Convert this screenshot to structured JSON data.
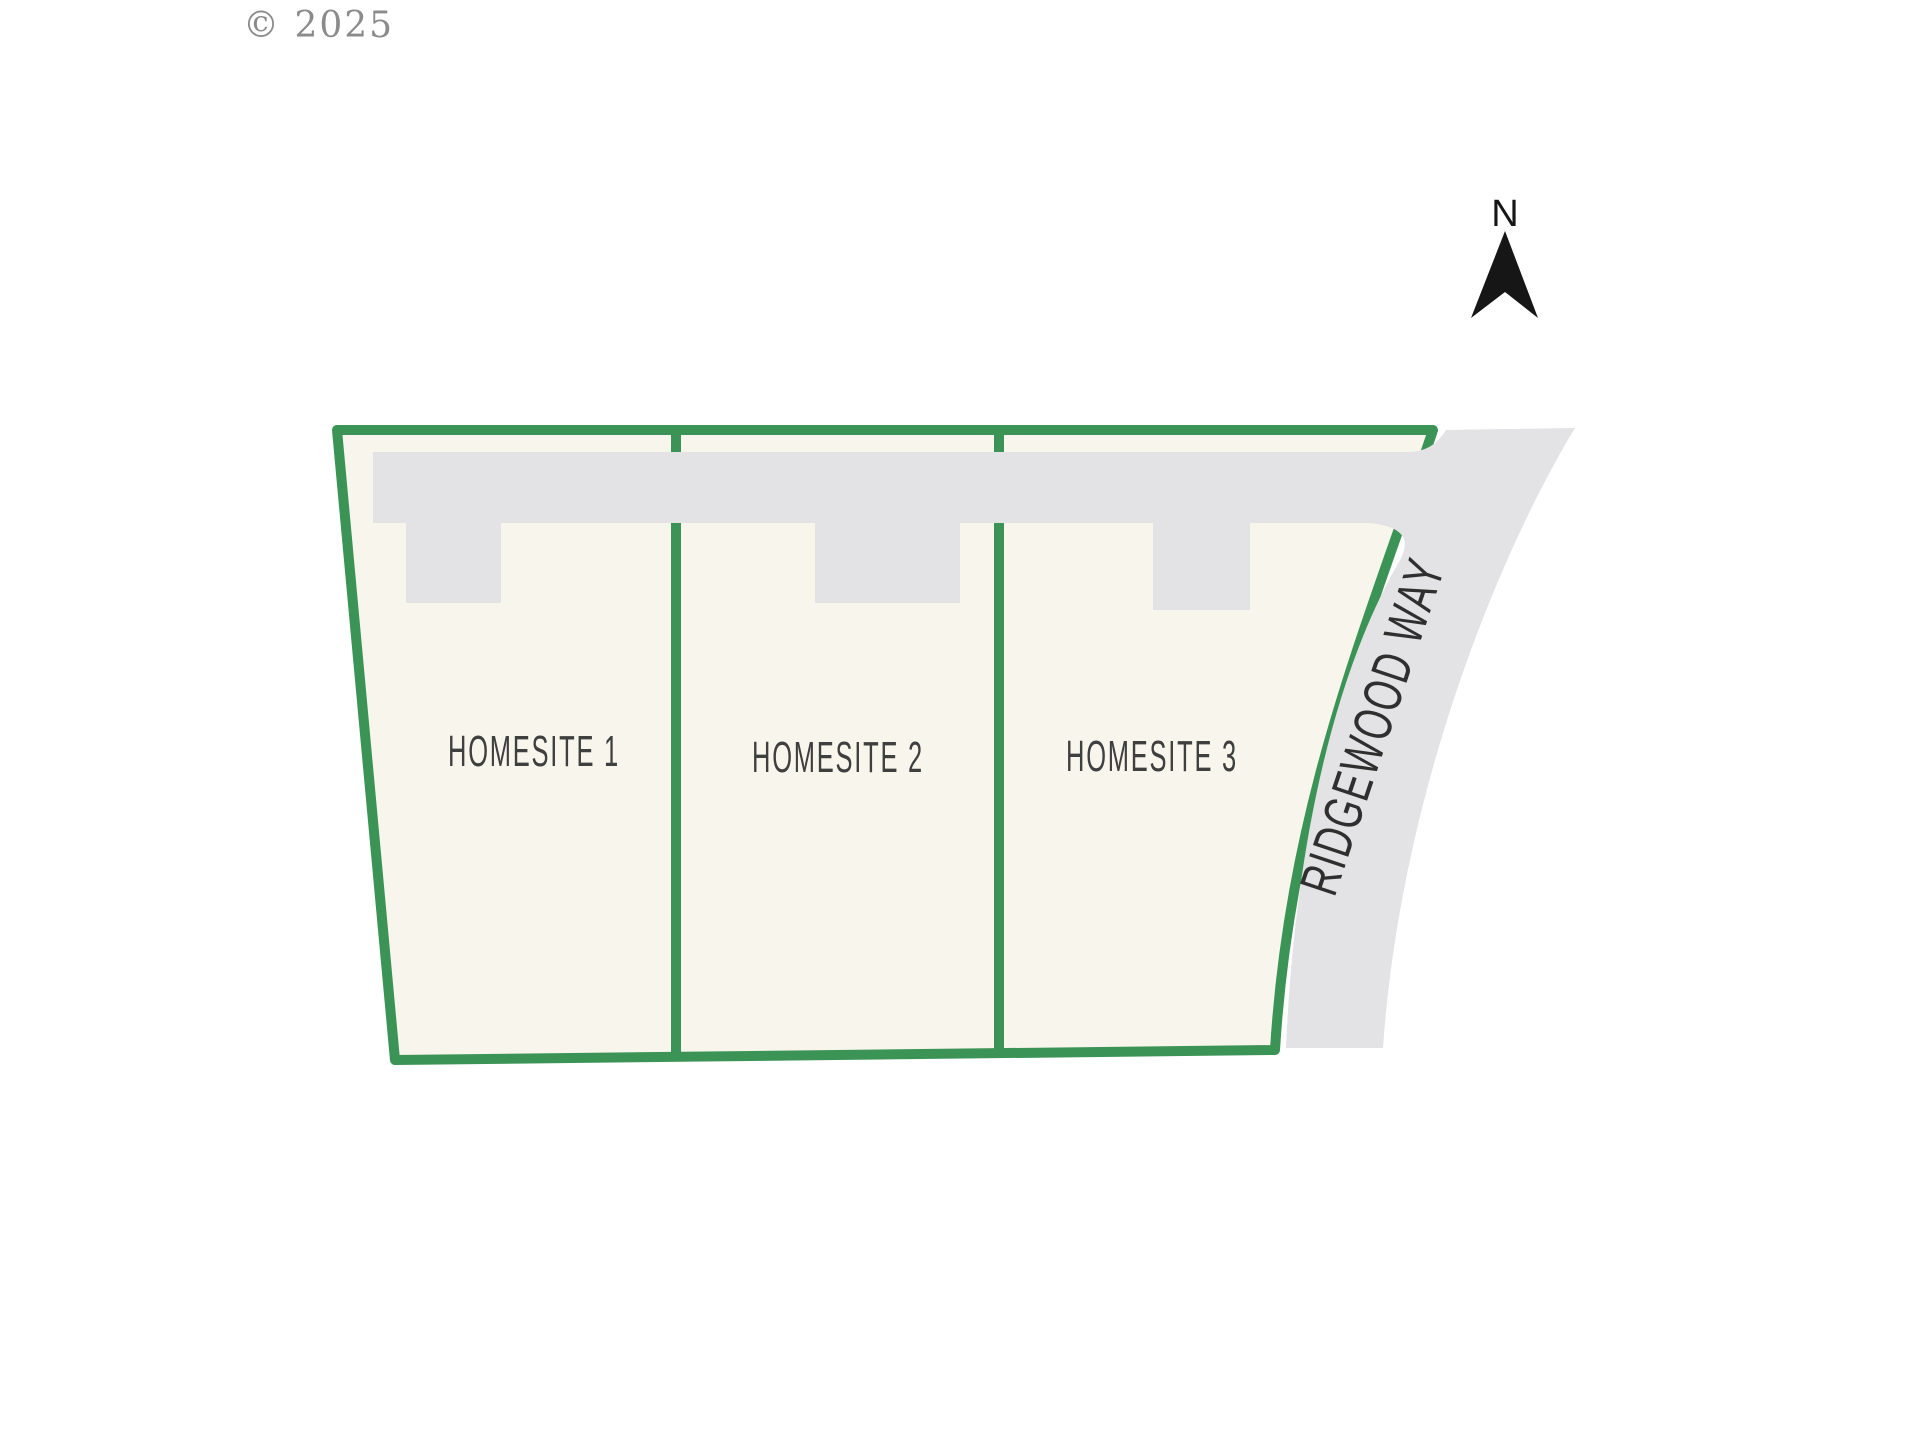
{
  "meta": {
    "copyright": "© 2025"
  },
  "north_indicator": {
    "label": "N"
  },
  "site_plan": {
    "lots": [
      {
        "label": "HOMESITE 1"
      },
      {
        "label": "HOMESITE 2"
      },
      {
        "label": "HOMESITE 3"
      }
    ],
    "road": {
      "name": "RIDGEWOOD WAY"
    }
  },
  "colors": {
    "boundary_green": "#3b9355",
    "parcel_cream": "#f7f5ec",
    "road_gray": "#e3e3e5",
    "label_gray": "#3f3f3f",
    "road_text": "#2f2f2f",
    "copyright_gray": "#8b8b8b",
    "arrow_black": "#161616",
    "background": "#ffffff"
  }
}
